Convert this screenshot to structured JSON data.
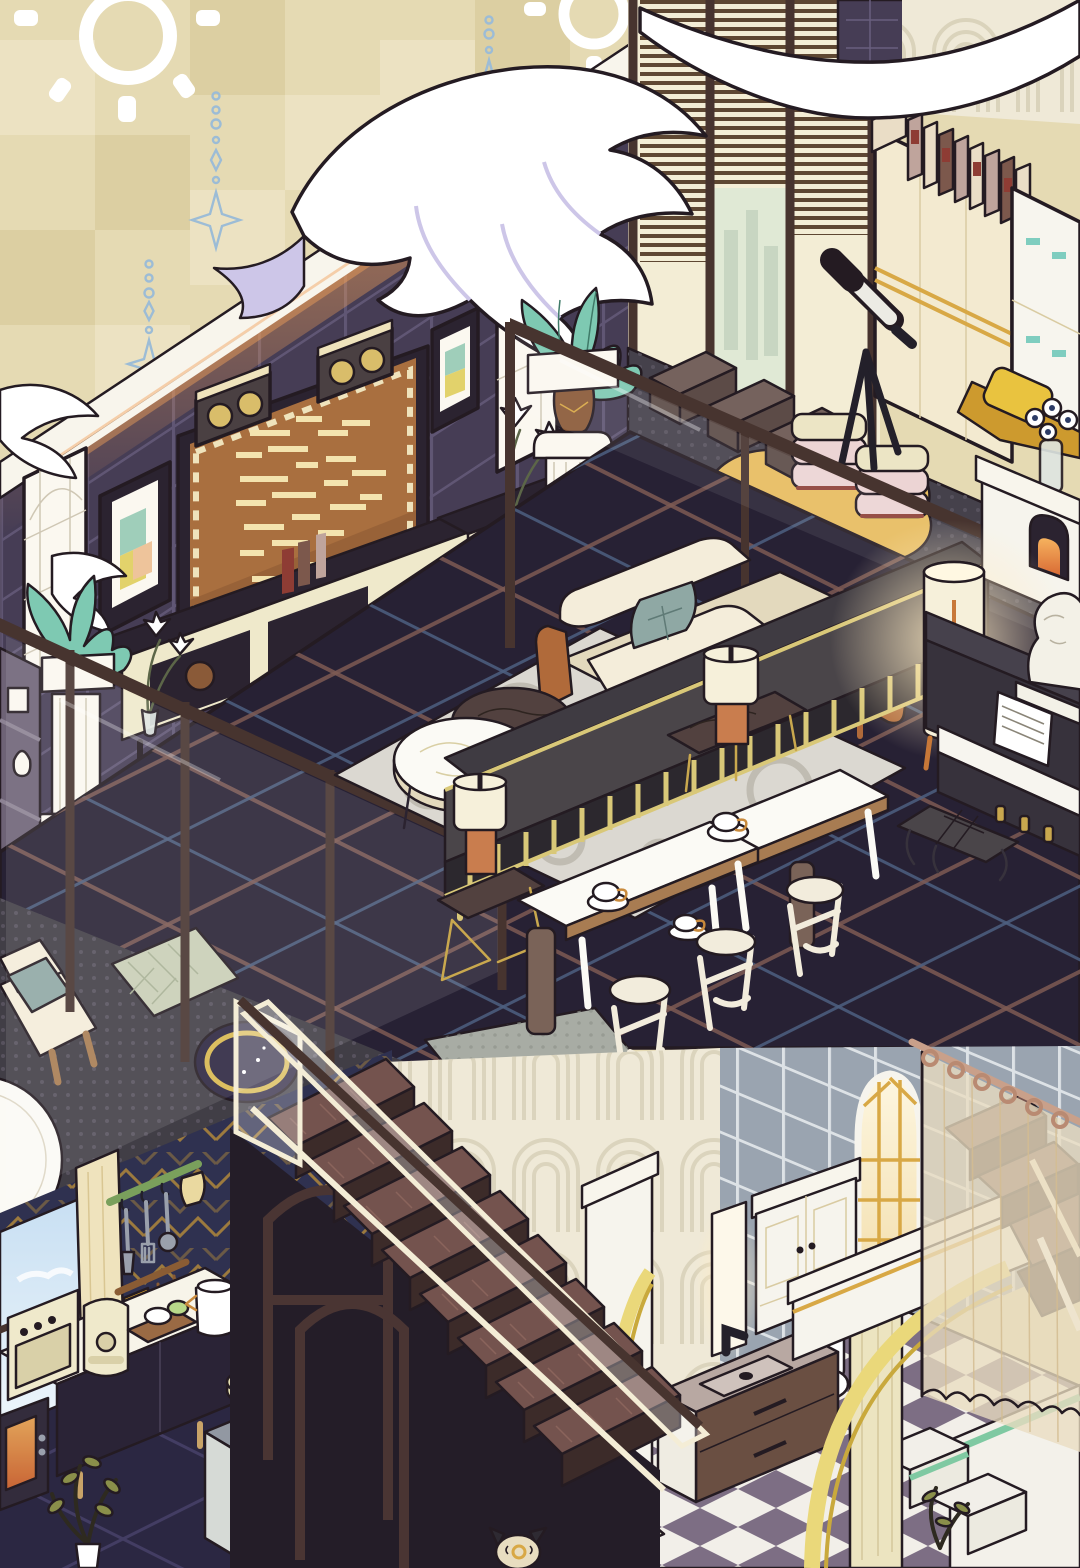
{
  "scene": {
    "title": "Isometric pixel-art loft apartment scene from a cozy home-decoration game",
    "style": "isometric cutaway, two levels, no UI text visible",
    "levels": [
      "upper loft: living room, media wall, lounge nook, dining corner, piano corner",
      "lower level: kitchen, staircase, bathroom with arches"
    ]
  },
  "palette": {
    "outline": "#241b22",
    "beige": "#e5dab3",
    "beigeLight": "#ece2c2",
    "beigeDark": "#dccfa2",
    "white": "#ffffff",
    "starBlue": "#9cbcd6",
    "featherTint": "#cdc6e8",
    "trimWhite": "#f8f5ec",
    "glowOrange": "#f2a159",
    "wallNavy": "#463d55",
    "wallGrout": "#695f7e",
    "boardBrown": "#a96f3f",
    "boardDark": "#8d5a33",
    "boardText": "#f3e3ae",
    "boardTrim": "#efe3bc",
    "speakerGold": "#d9bd6a",
    "speakerFace": "#4a4042",
    "frameDark": "#2b2330",
    "artTeal": "#9fceba",
    "artYellow": "#e2d26b",
    "artPeach": "#eec49b",
    "winWhite": "#fbf8f0",
    "winLattice": "#cfc7b4",
    "glassFrame": "#47342f",
    "railCream": "#f4edd6",
    "blindBrown": "#5e4732",
    "doorCream": "#f3edd5",
    "cityGreen": "#e0e9d5",
    "cityTower": "#c8d6c2",
    "decoCream": "#efe9d7",
    "decoLine": "#d8d0b8",
    "bookMauve": "#bfa49c",
    "bookCream": "#eaddc6",
    "bookBrown": "#7c584c",
    "bookRed": "#8e3c34",
    "wardrobeCream": "#f3ead0",
    "wardrobeSeam": "#d9cba2",
    "pipingGold": "#d8a845",
    "lockerWhite": "#f7f5ee",
    "lockerTeal": "#7fcdbf",
    "matCharcoal": "#45414b",
    "matDot": "#57525e",
    "leather": "#75625d",
    "leatherDark": "#5c4b47",
    "cushionCream": "#ece5c5",
    "cushionPink": "#ecd4d4",
    "cushionRed": "#8e4038",
    "rugYellow": "#e8bc5f",
    "seatYellow": "#e9c33f",
    "seatMatGold": "#cd9a2e",
    "floorDark": "#272134",
    "plaidRed": "#7d5a53",
    "plaidBlue": "#4d5f80",
    "rugGray": "#dbd8d1",
    "rugRing": "#c0bcb2",
    "sofaCream": "#f4edda",
    "sofaShade": "#e3d9bd",
    "pillowTeal": "#8fa8a4",
    "armWood": "#b06a3a",
    "benchDark": "#3f3b42",
    "benchSeat": "#4a4549",
    "brassGold": "#d9c878",
    "marbleDark": "#52413f",
    "marbleVein": "#2e2420",
    "lampOrange": "#c97d4e",
    "shadeCream": "#f6f0da",
    "tableWhite": "#fbfaf5",
    "woodTrim": "#a87c52",
    "stoolCream": "#f2ecdc",
    "pianoDark": "#37323c",
    "pianoLid": "#46414c",
    "keyWhite": "#f7f5ef",
    "pedalGold": "#c9a84e",
    "bustWhite": "#f3f1e7",
    "fireOrange": "#d96b35",
    "fireGlow": "#f6b25e",
    "stairWood": "#5e4240",
    "stairTread": "#74534e",
    "stairRiser": "#3c2b29",
    "kitchenNavy": "#2f3150",
    "chevronGold": "#a8823c",
    "kitchenGrid": "#433d63",
    "skyTop": "#c6def2",
    "skyBottom": "#eef6fb",
    "curtainCream": "#efe3bd",
    "curtainFold": "#d9c692",
    "railGreen": "#7aa05c",
    "railBrown": "#8a5c34",
    "towelYellow": "#e2a92c",
    "utensil": "#9aa0ac",
    "counterWhite": "#f7f4e9",
    "cabinetDark": "#2a2336",
    "applianceCream": "#efe9cb",
    "applianceShade": "#d9d0a8",
    "stoveWhite": "#eef1ec",
    "stoveTop": "#9298a2",
    "stoveSide": "#d6dad6",
    "ovenGlass": "#3c3f48",
    "copper": "#c87838",
    "potCream": "#e6e0b2",
    "counterPale": "#dfe3e0",
    "tileBlue": "#9aa4b0",
    "tileGrout": "#e9edef",
    "doorWhite": "#f6f4ed",
    "archYellow": "#ead87a",
    "archYellowDark": "#c9a93c",
    "checkerMauve": "#7d6e84",
    "checkerWhite": "#f2efe9",
    "mintStripe": "#7fc9a2",
    "sageMat": "#c9cfb6",
    "sageStripe": "#a6af94",
    "nightRug": "#2c2540",
    "ringGold": "#d9b84e",
    "vanityTaupe": "#b8a8a2",
    "vanityBasin": "#cfc2bc",
    "vanityBrown": "#6a4f42",
    "faucetBlack": "#23202a",
    "glowWarm": "#ffecc4",
    "plantTeal": "#7ec9b2",
    "plantPot": "#8a5a38",
    "plantOlive": "#8a8f4a",
    "stemDark": "#2e2a20",
    "vaseCream": "#ece4c0",
    "glassVase": "#dfe6e2",
    "curtainSheer": "#e9dcc0",
    "curtainStripe": "#d4bd92",
    "landingGray": "#a8aca4",
    "landingDot": "#8f948c",
    "platDark": "#413e46",
    "woodLeg": "#c8a368",
    "teacupGold": "#c98a3c",
    "catCream": "#e8ddc0",
    "laptopDark": "#2e2a32"
  },
  "objects": {
    "wall_decor": [
      "sun-ornament (x2)",
      "star-garland (x3)",
      "feather-garland (white plumes draped over walls)",
      "glowing-strip-light",
      "lattice-window (x2)",
      "art-frame geometric print (x2)",
      "message-board-screen with dashed marquee text",
      "wall-speaker (x2)"
    ],
    "lounge_nook": [
      "sliding-glass-doors with blinds",
      "city-view-panel",
      "art-deco-wall",
      "wardrobe cream",
      "book-row (11 books)",
      "locker-cabinet with teal latches",
      "telescope on tripod",
      "leather-floor-cushion (x3)",
      "cushion-stack pink/cream (x2)",
      "yellow-blob-rug",
      "yellow-floor-seat",
      "daisy-vase"
    ],
    "living_room": [
      "pedestal-column with teal plant (x2)",
      "lily-vase (x2)",
      "tv-console with books",
      "tv-sideboard",
      "display-shelf",
      "glass-partition railing",
      "circle-pattern-rug",
      "cream-sofa with teal pillow and wood arms",
      "brass-frame-bench-sofa (charcoal)",
      "round-coffee-table (cream marble)",
      "round-pouf (dark)",
      "marble-side-table (x2)",
      "cylinder-lamp orange/cream (x2)"
    ],
    "dining_corner": [
      "white-dining-table (x2)",
      "teacup-and-saucer (x3)",
      "white-stool (x3)",
      "wood-post (x2)"
    ],
    "piano_corner": [
      "upright-piano",
      "piano-keys",
      "sheet-music",
      "classical-bust",
      "piano-bench",
      "gold-pedals (x3)",
      "glowing-floor-lamp",
      "white-fireplace with fire",
      "mantel-flower-vase"
    ],
    "landing": [
      "halftone-platform",
      "gray-landing-mat",
      "night-sky-round-rug with gold ring",
      "sage-chevron-mat",
      "white-chaise with teal cushion",
      "round-white-table"
    ],
    "kitchen": [
      "navy-gold-chevron-wallpaper",
      "window with sky view",
      "cream-curtain",
      "green-utensil-rail with spatulas and mitt",
      "brown-rail with yellow towel and ladles",
      "white-counter",
      "dark-base-cabinets with wood legs",
      "microwave (glowing)",
      "toaster-oven",
      "air-fryer",
      "cutting-board with bowls",
      "white-coffee-pot",
      "stove-oven with glass door",
      "copper-kettle",
      "cream-casserole-pot",
      "white-side-counter",
      "black-frame-table",
      "potted-plant"
    ],
    "staircase": [
      "wood-stair-steps (x8)",
      "glass-stair-railing with cream frame",
      "dark-handrail",
      "gothic-arch-supports",
      "rear-staircase behind curtain"
    ],
    "bathroom": [
      "art-deco-arch-wall",
      "blue-gray-tile-wall",
      "gold-arched-window",
      "bathroom-cabinet",
      "mirror-light",
      "vanity-sink with black faucet",
      "toilet with teal button",
      "white-arch-partition with yellow arc (x2)",
      "fluted-column",
      "checkerboard-floor",
      "tiled-tub-steps with mint stripe",
      "tall-vase-plant",
      "small-plant",
      "sage-bath-mat",
      "bench-with-laptop",
      "shower-curtain-rod with rings",
      "sheer-striped-shower-curtain",
      "cat-figure"
    ]
  }
}
